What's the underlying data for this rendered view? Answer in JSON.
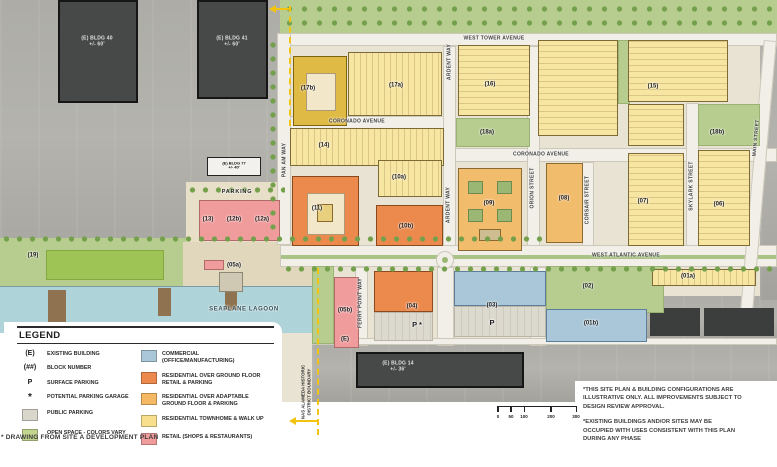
{
  "colors": {
    "commercial_blue": "#aac7d9",
    "residential_over_retail_orange": "#ec8a4e",
    "residential_adaptable_orange": "#f5b964",
    "residential_townhome_yellow": "#f7e6a2",
    "retail_pink": "#f19c9c",
    "public_parking_gray": "#d9d6cb",
    "open_space_green": "#b7cd90",
    "water_blue": "#aed3d9",
    "boundary_yellow": "#f2c410",
    "existing_building_gray": "#474848"
  },
  "map": {
    "streets": {
      "west_tower": "WEST TOWER AVENUE",
      "coronado": "CORONADO AVENUE",
      "west_atlantic": "WEST ATLANTIC AVENUE",
      "pan_am": "PAN AM WAY",
      "ardent": "ARDENT WAY",
      "orion": "ORION STREET",
      "corsair": "CORSAIR STREET",
      "skylark": "SKYLARK STREET",
      "main": "MAIN STREET",
      "ferry_point": "FERRY POINT WAY"
    },
    "blocks": {
      "b01a": "(01a)",
      "b01b": "(01b)",
      "b02": "(02)",
      "b03": "(03)",
      "b04": "(04)",
      "b05a": "(05a)",
      "b05b": "(05b)",
      "b05b_e": "(E)",
      "b06": "(06)",
      "b07": "(07)",
      "b08": "(08)",
      "b09": "(09)",
      "b10a": "(10a)",
      "b10b": "(10b)",
      "b11": "(11)",
      "b12a": "(12a)",
      "b12b": "(12b)",
      "b13": "(13)",
      "b14": "(14)",
      "b15": "(15)",
      "b16": "(16)",
      "b17a": "(17a)",
      "b17b": "(17b)",
      "b18a": "(18a)",
      "b18b": "(18b)",
      "b19": "(19)"
    },
    "existing": {
      "bldg40": "(E) BLDG 40",
      "bldg40_h": "+/- 60'",
      "bldg41": "(E) BLDG 41",
      "bldg41_h": "+/- 60'",
      "bldg77": "(E) BLDG 77",
      "bldg77_h": "+/- 40'",
      "bldg14": "(E) BLDG 14",
      "bldg14_h": "+/- 36'"
    },
    "labels": {
      "water": "SEAPLANE LAGOON",
      "parking": "PARKING",
      "p": "P",
      "p_star": "P *",
      "boundary_line1": "NAS ALAMEDA HISTORIC",
      "boundary_line2": "DISTRICT BOUNDARY"
    }
  },
  "legend": {
    "title": "LEGEND",
    "symbol_items": [
      {
        "symbol": "(E)",
        "label": "EXISTING BUILDING"
      },
      {
        "symbol": "(##)",
        "label": "BLOCK NUMBER"
      },
      {
        "symbol": "P",
        "label": "SURFACE PARKING"
      },
      {
        "symbol": "*",
        "label": "POTENTIAL PARKING GARAGE"
      },
      {
        "symbol": "",
        "label": "PUBLIC PARKING",
        "swatch": "#d9d6cb"
      },
      {
        "symbol": "",
        "label": "OPEN SPACE - COLORS VARY",
        "swatch": "#c3d68f"
      }
    ],
    "color_items": [
      {
        "swatch": "#aac7d9",
        "label": "COMMERCIAL (OFFICE/MANUFACTURING)"
      },
      {
        "swatch": "#ec8a4e",
        "label": "RESIDENTIAL OVER GROUND FLOOR RETAIL & PARKING"
      },
      {
        "swatch": "#f5b964",
        "label": "RESIDENTIAL OVER ADAPTABLE GROUND FLOOR & PARKING"
      },
      {
        "swatch": "#f7df8e",
        "label": "RESIDENTIAL TOWNHOME & WALK UP"
      },
      {
        "swatch": "#f19c9c",
        "label": "RETAIL (SHOPS & RESTAURANTS)"
      }
    ]
  },
  "notes": {
    "note1": "*THIS SITE PLAN & BUILDING CONFIGURATIONS ARE ILLUSTRATIVE ONLY. ALL IMPROVEMENTS SUBJECT TO DESIGN REVIEW APPROVAL.",
    "note2": "*EXISTING BUILDINGS AND/OR SITES MAY BE OCCUPIED WITH USES CONSISTENT WITH THIS PLAN DURING ANY PHASE"
  },
  "footnote": "* DRAWING FROM SITE A DEVELOPMENT PLAN",
  "scale": {
    "ticks": [
      "0",
      "50",
      "100",
      "200",
      "300"
    ]
  }
}
